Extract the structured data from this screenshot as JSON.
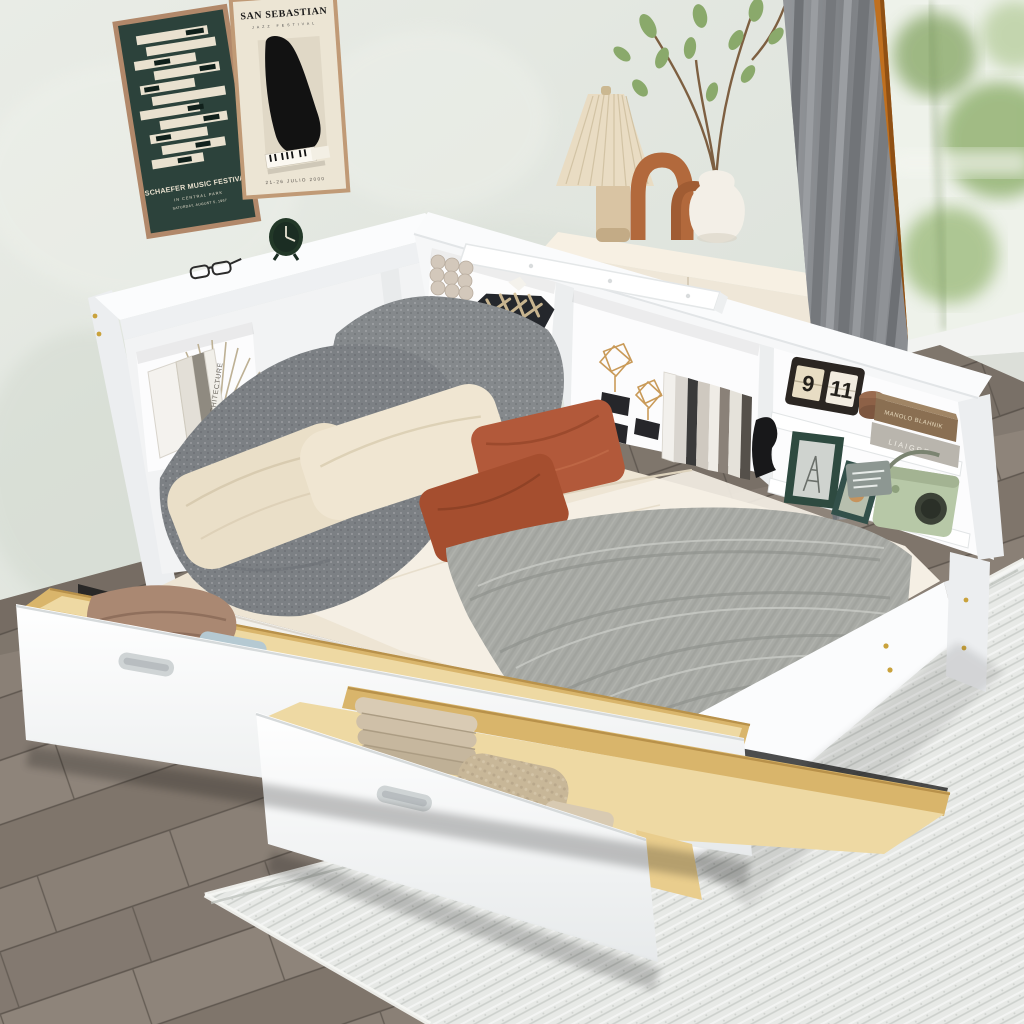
{
  "posters": {
    "schaefer": {
      "line1": "SCHAEFER MUSIC FESTIVAL",
      "line2": "IN CENTRAL PARK",
      "line3": "SATURDAY, AUGUST 5, 1967",
      "background": "#2c423b",
      "bar_color": "#e9e1cf",
      "frame_color": "#b1886a"
    },
    "san_sebastian": {
      "title": "SAN SEBASTIAN",
      "subtitle": "JAZZ FESTIVAL",
      "date": "21-26 JULIO 2000",
      "background": "#ece5d4",
      "piano_color": "#121212",
      "frame_color": "#c09a76"
    }
  },
  "flip_calendar": {
    "left": "9",
    "right": "11"
  },
  "book_spines": {
    "architecture": "ARCHITECTURE",
    "finance": "FINANCE",
    "manolo": "MANOLO BLAHNIK",
    "liaigre": "LIAIGRE"
  },
  "palette": {
    "wall": "#e2e6e0",
    "wall_shade": "#d3d9d2",
    "curtain": "#85888c",
    "window_frame": "#c0701f",
    "glass": "#eef2ea",
    "foliage": "#8aa96b",
    "sill_white": "#f2f3f1",
    "dresser": "#efe7d8",
    "lamp_shade": "#e9dcc3",
    "lamp_base": "#d9c4a3",
    "arch_decor": "#b2693c",
    "vase": "#f3efe7",
    "bed_white": "#f6f7f8",
    "bed_shadow_side": "#eceef0",
    "mattress_side": "#f3f1ec",
    "sheet": "#eee5d4",
    "sheet_fold": "#f5f0e5",
    "pillow_beige_1": "#ead fc8",
    "pillow_beige": "#eadfc8",
    "pillow_beige_light": "#f0e6d2",
    "pillow_rust": "#b2593a",
    "pillow_rust_dark": "#a54e2f",
    "pillow_gray": "#85898c",
    "blanket_gray": "#a8aaa5",
    "drawer_wood": "#d9b56b",
    "drawer_wood_light": "#eed9a3",
    "floor_wood": "#877d73",
    "rug": "#e7e9e6",
    "clock_green": "#223828",
    "frame_green": "#2e4a40",
    "radio_green": "#b7c8a7",
    "basket_black": "#24272c",
    "brass": "#c9a23c"
  }
}
